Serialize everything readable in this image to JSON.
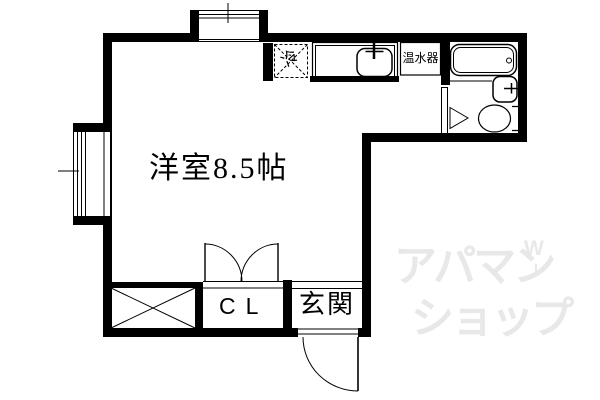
{
  "room": {
    "label": "洋室8.5帖"
  },
  "closet": {
    "label": "CL"
  },
  "entrance": {
    "label": "玄関"
  },
  "kitchen": {
    "refrigerator_label": "冷",
    "water_heater_label": "温水器"
  },
  "watermark": {
    "line1": "アパマン",
    "line2": "ショップ",
    "mark_top": "W",
    "mark_bottom": "L"
  },
  "colors": {
    "wall": "#000000",
    "bg": "#ffffff",
    "ink": "#000000",
    "watermark": "#e8e8e8"
  }
}
